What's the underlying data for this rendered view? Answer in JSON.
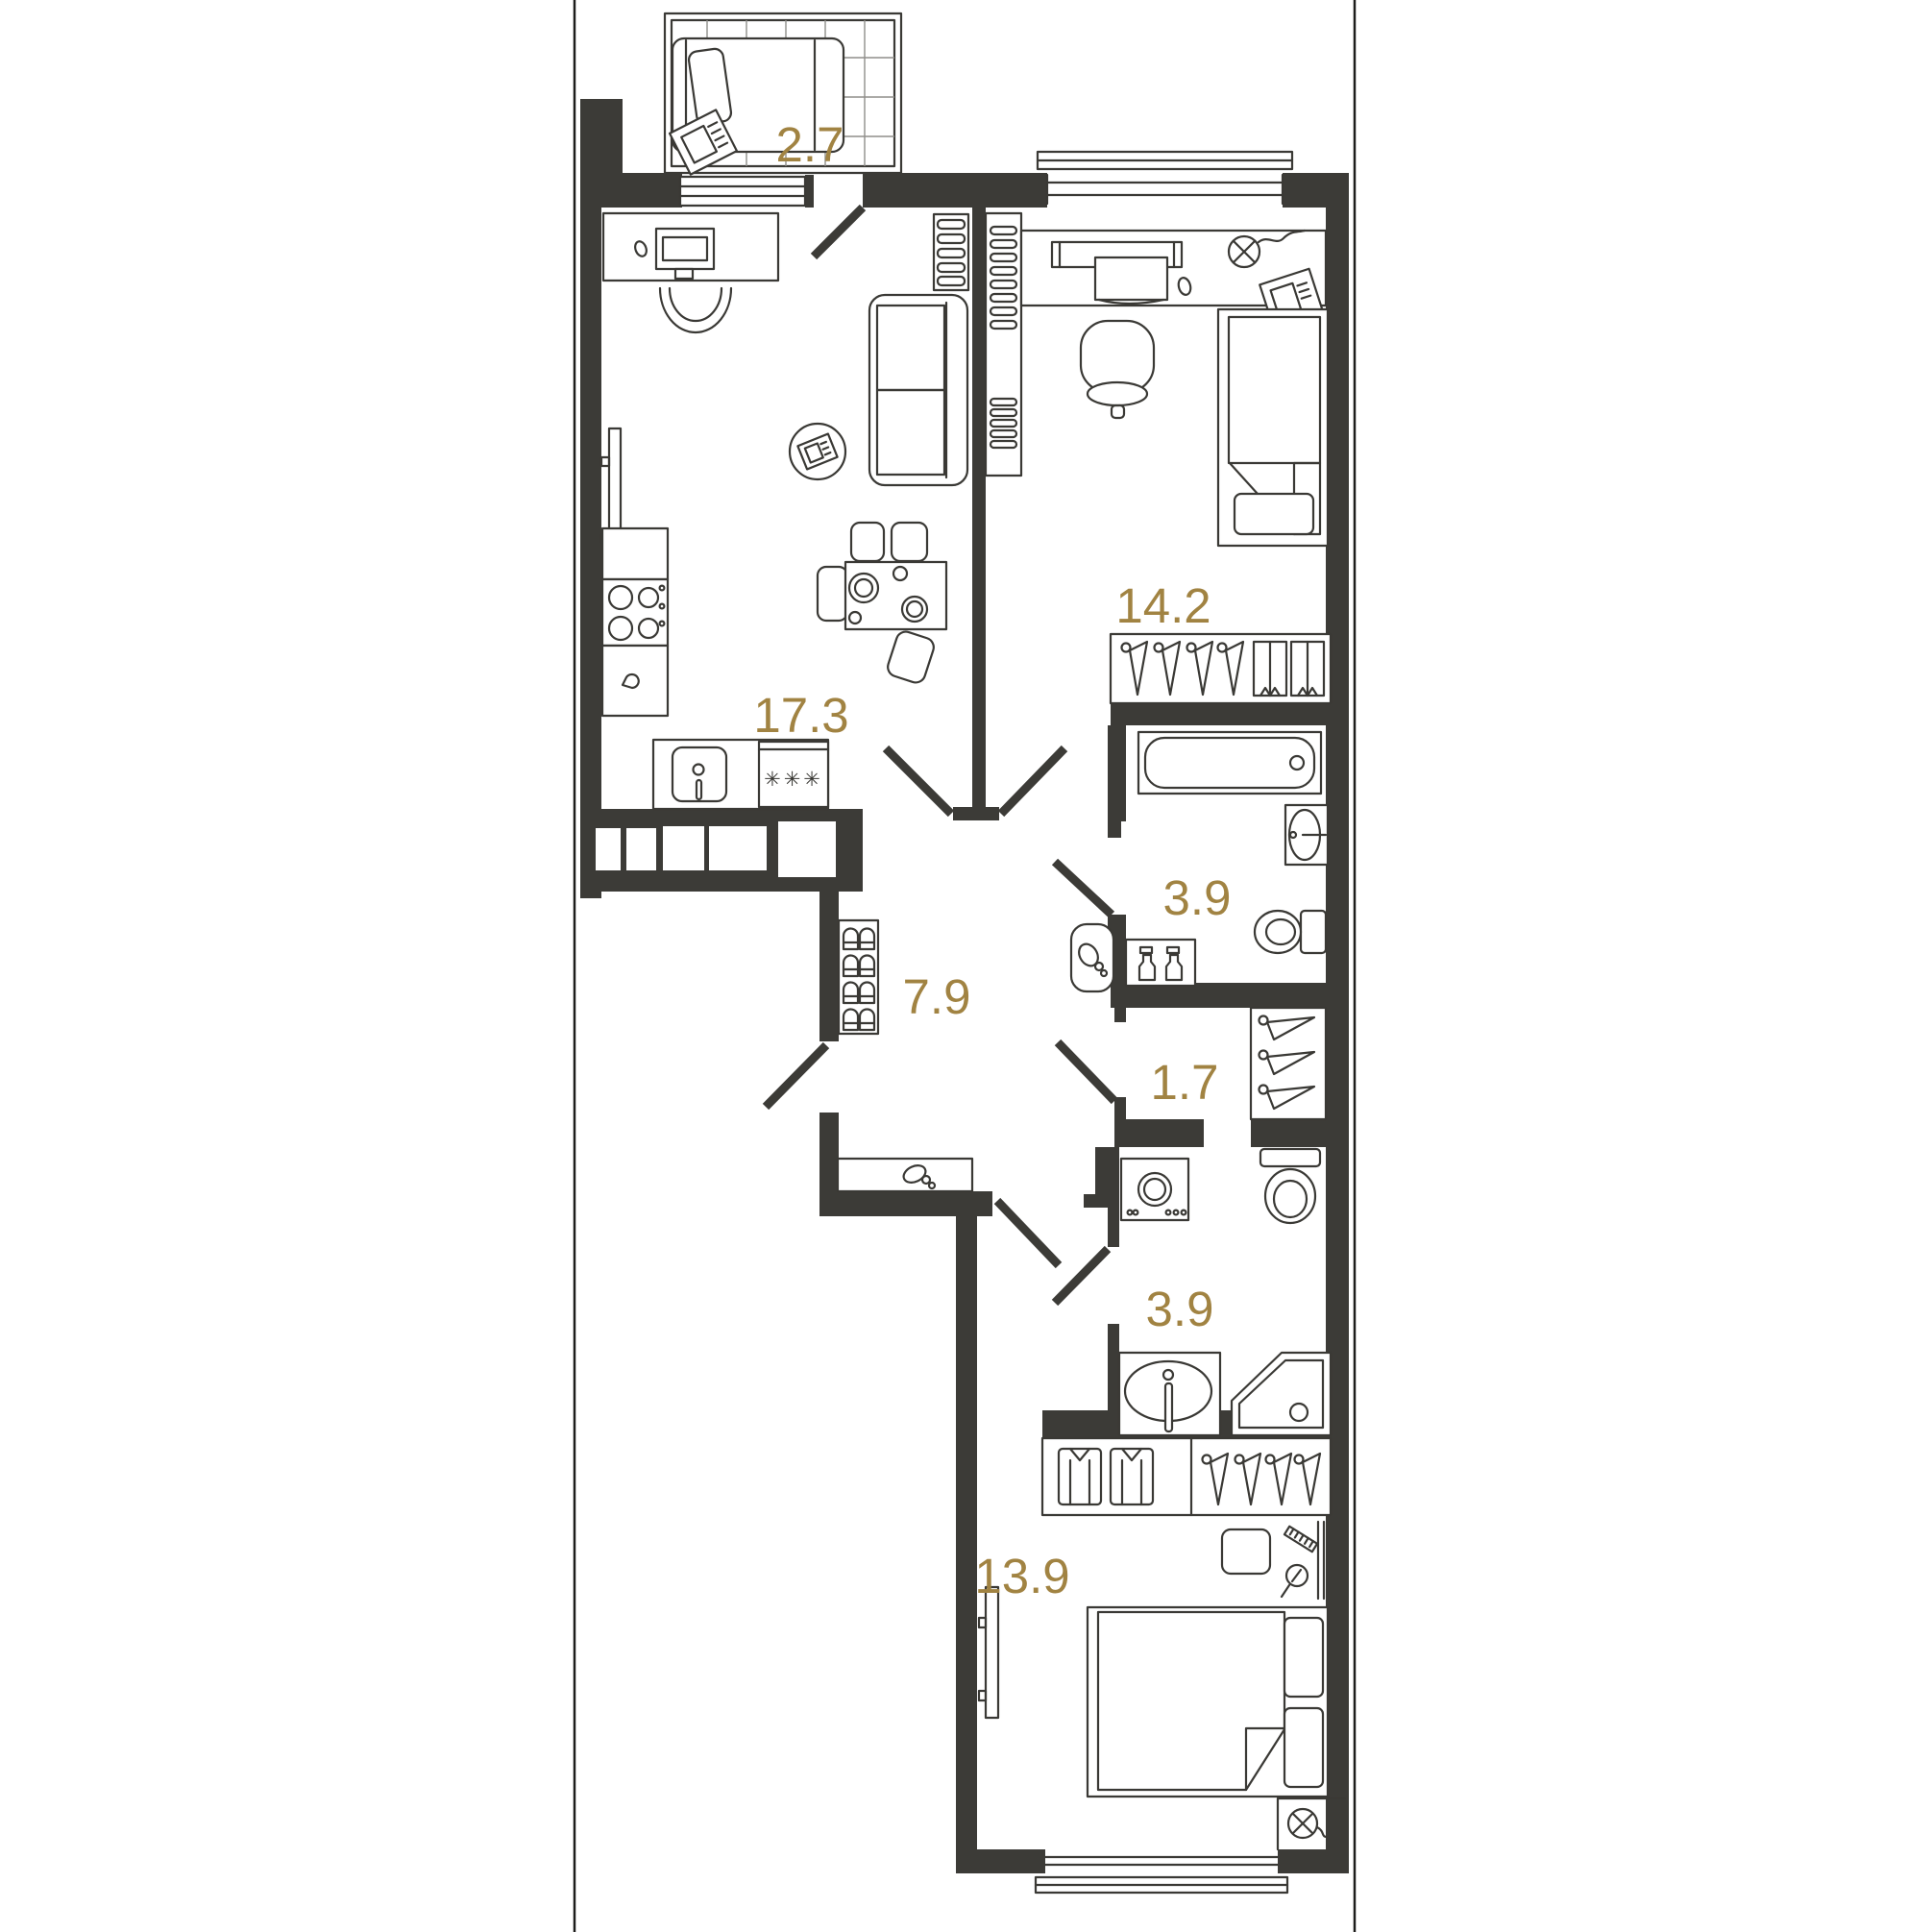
{
  "title": "Apartment floor plan",
  "accent_color": "#a18342",
  "wall_color": "#3c3b37",
  "rooms": [
    {
      "name": "balcony",
      "area": "2.7"
    },
    {
      "name": "kitchen-living-room",
      "area": "17.3"
    },
    {
      "name": "bedroom",
      "area": "14.2"
    },
    {
      "name": "bathroom",
      "area": "3.9"
    },
    {
      "name": "hallway",
      "area": "7.9"
    },
    {
      "name": "wardrobe",
      "area": "1.7"
    },
    {
      "name": "shower-room",
      "area": "3.9"
    },
    {
      "name": "bedroom-2",
      "area": "13.9"
    }
  ],
  "kitchen": {
    "freezer_label": "✳✳✳"
  },
  "icons": [
    "lounger",
    "magazine",
    "desk",
    "monitor",
    "mouse",
    "office-chair",
    "tv",
    "sofa",
    "coffee-table",
    "dining-table",
    "chairs",
    "stove",
    "kitchen-sink",
    "cabinet",
    "radiator-shelf",
    "bed",
    "pillow",
    "wardrobe-hangers",
    "drawer-unit",
    "bathtub",
    "washbasin",
    "toilet",
    "spray-bottles",
    "laundry-basket",
    "shoe-rack",
    "console-shelf",
    "washing-machine",
    "corner-shower",
    "shirt",
    "comb",
    "hand-mirror",
    "nightstand",
    "ceiling-lamp",
    "window",
    "door-leaf"
  ]
}
